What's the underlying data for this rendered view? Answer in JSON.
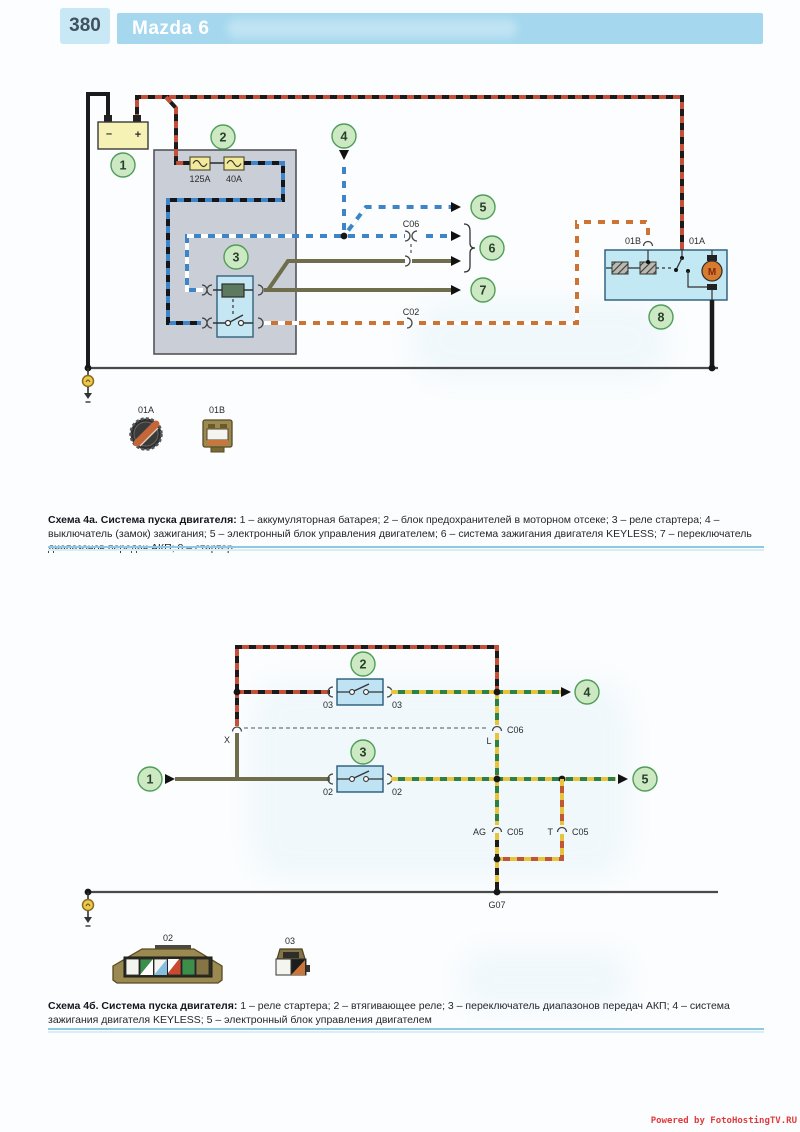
{
  "header": {
    "page_number": "380",
    "title": "Mazda 6"
  },
  "footer": {
    "credit": "Powered by FotoHostingTV.RU"
  },
  "colors": {
    "header_band": "#a5d8ee",
    "callout_green": "#4f9e58",
    "component_blue": "#c5e6f3",
    "fusebox_gray": "#caced6",
    "battery_yellow": "#f6f2b6",
    "wire_blue": "#3d85c8",
    "wire_olive": "#6e6e4c",
    "wire_black": "#1b1b1b",
    "wire_red": "#c4503a",
    "wire_green": "#2e8044",
    "wire_yellow": "#e6c43e",
    "wire_orange": "#cd7435",
    "credit_red": "#e23b3b"
  },
  "diagram1": {
    "callout1": "1",
    "callout2": "2",
    "callout3": "3",
    "callout4": "4",
    "callout5": "5",
    "callout6": "6",
    "callout7": "7",
    "callout8": "8",
    "battery_minus": "–",
    "battery_plus": "+",
    "fuse1": "125A",
    "fuse2": "40A",
    "c06": "C06",
    "c02": "C02",
    "b01": "01B",
    "a01": "01A",
    "motor": "M",
    "legend_a01": "01A",
    "legend_b01": "01B",
    "caption_title": "Схема 4а. Система пуска двигателя:",
    "caption_body": "1 – аккумуляторная батарея; 2 – блок предохранителей в моторном отсеке; 3 – реле стартера; 4 – выключатель (замок) зажигания; 5 – электронный блок управления двигателем; 6 – система зажигания двигателя KEYLESS; 7 – переключатель диапазонов передач АКП; 8 – стартер"
  },
  "diagram2": {
    "callout1": "1",
    "callout2": "2",
    "callout3": "3",
    "callout4": "4",
    "callout5": "5",
    "relay1_pin_left": "03",
    "relay1_pin_right": "03",
    "relay2_pin_left": "02",
    "relay2_pin_right": "02",
    "x_label": "X",
    "l_label": "L",
    "c06": "C06",
    "ag_label": "AG",
    "c05_left": "C05",
    "t_label": "T",
    "c05_right": "C05",
    "g07": "G07",
    "conn02_label": "02",
    "conn03_label": "03",
    "caption_title": "Схема 4б. Система пуска двигателя:",
    "caption_body": "1 – реле стартера; 2 – втягивающее реле; 3 – переключатель диапазонов передач АКП; 4 – система зажигания двигателя KEYLESS; 5 – электронный блок управления двигателем"
  }
}
